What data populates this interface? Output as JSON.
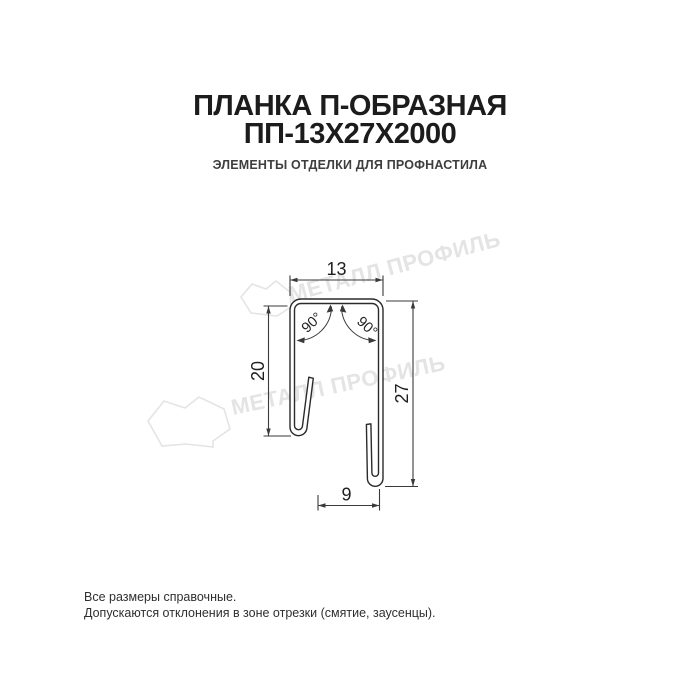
{
  "header": {
    "title_line1": "ПЛАНКА П-ОБРАЗНАЯ",
    "title_line2": "ПП-13Х27Х2000",
    "subtitle": "ЭЛЕМЕНТЫ ОТДЕЛКИ ДЛЯ ПРОФНАСТИЛА"
  },
  "drawing": {
    "type": "technical-cross-section",
    "product": "П-образная планка (U-shaped profile)",
    "dimensions": {
      "top_width": "13",
      "left_height": "20",
      "right_height": "27",
      "bottom_width": "9",
      "angle_left": "90°",
      "angle_right": "90°"
    },
    "watermark": {
      "text": "МЕТАЛЛ ПРОФИЛЬ",
      "color": "#e4e4e4"
    },
    "colors": {
      "profile_line": "#2b2b2b",
      "dimension_line": "#3a3a3a",
      "dimension_text": "#1f1f1f"
    }
  },
  "footer": {
    "line1": "Все размеры справочные.",
    "line2": "Допускаются отклонения в зоне отрезки (смятие, заусенцы)."
  },
  "colors": {
    "background": "#ffffff",
    "title": "#1c1c1c",
    "subtitle": "#3e3e3e",
    "footer": "#2f2f2f"
  }
}
